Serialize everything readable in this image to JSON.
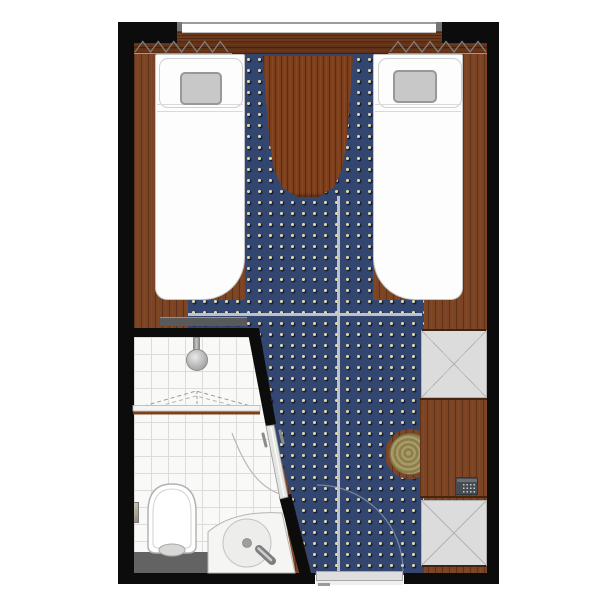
{
  "page": {
    "title": "Twin Cabin Floor Plan",
    "description": "Top-down architectural floor plan of a twin-bed room with en-suite bathroom, no visible text labels",
    "canvas": "600x600"
  },
  "palette": {
    "wall": "#0c0c0c",
    "wood_floor": "#7b4424",
    "wood_trim_dark": "#5e3118",
    "table_wood": "#7d401e",
    "carpet_navy": "#32466f",
    "carpet_dot_cream": "#ddd6a8",
    "carpet_dot_shadow": "#16203c",
    "bed_white": "#fdfdfd",
    "pillow_gray": "#c8c8c8",
    "wardrobe_gray": "#dcdcdc",
    "tile_white": "#f9f9f7",
    "bench_charcoal": "#57595b",
    "stool_tan": "#a49763",
    "safe_slate": "#474c52",
    "door_gray": "#dedede",
    "seam_gray": "#c7cdd3"
  },
  "elements": {
    "window": {
      "label": "window at top wall between black wall corners"
    },
    "curtains": {
      "label": "zigzag curtain symbols left and right of window"
    },
    "bed_left": {
      "label": "left twin bed with gray pillow, rounded foot corners"
    },
    "bed_right": {
      "label": "right twin bed with gray pillow, rounded foot corners"
    },
    "table": {
      "label": "curved wooden table between bed heads on carpet runner"
    },
    "carpet": {
      "label": "navy carpet with cream dot grid, T-shaped walkway with seam lines"
    },
    "bench": {
      "label": "charcoal luggage bench at foot of left bed"
    },
    "wardrobe_upper": {
      "label": "upper wardrobe with X symbol, right wall"
    },
    "wardrobe_lower": {
      "label": "lower wardrobe with X symbol, right wall"
    },
    "counter": {
      "label": "wooden counter between wardrobes"
    },
    "safe": {
      "label": "safe with keypad on counter"
    },
    "stool": {
      "label": "round patterned stool tucked under counter"
    },
    "bathroom": {
      "label": "tiled bathroom, bottom left, angled entry wall"
    },
    "shower": {
      "label": "shower head with folding screen, dashed swing lines, wood threshold"
    },
    "toilet": {
      "label": "toilet with cistern bench and paper holder"
    },
    "sink": {
      "label": "round basin in corner counter with faucet"
    },
    "bath_door": {
      "label": "bathroom door on angled wall with swing arc and handles"
    },
    "entrance": {
      "label": "entrance door at bottom wall with swing arc"
    }
  }
}
